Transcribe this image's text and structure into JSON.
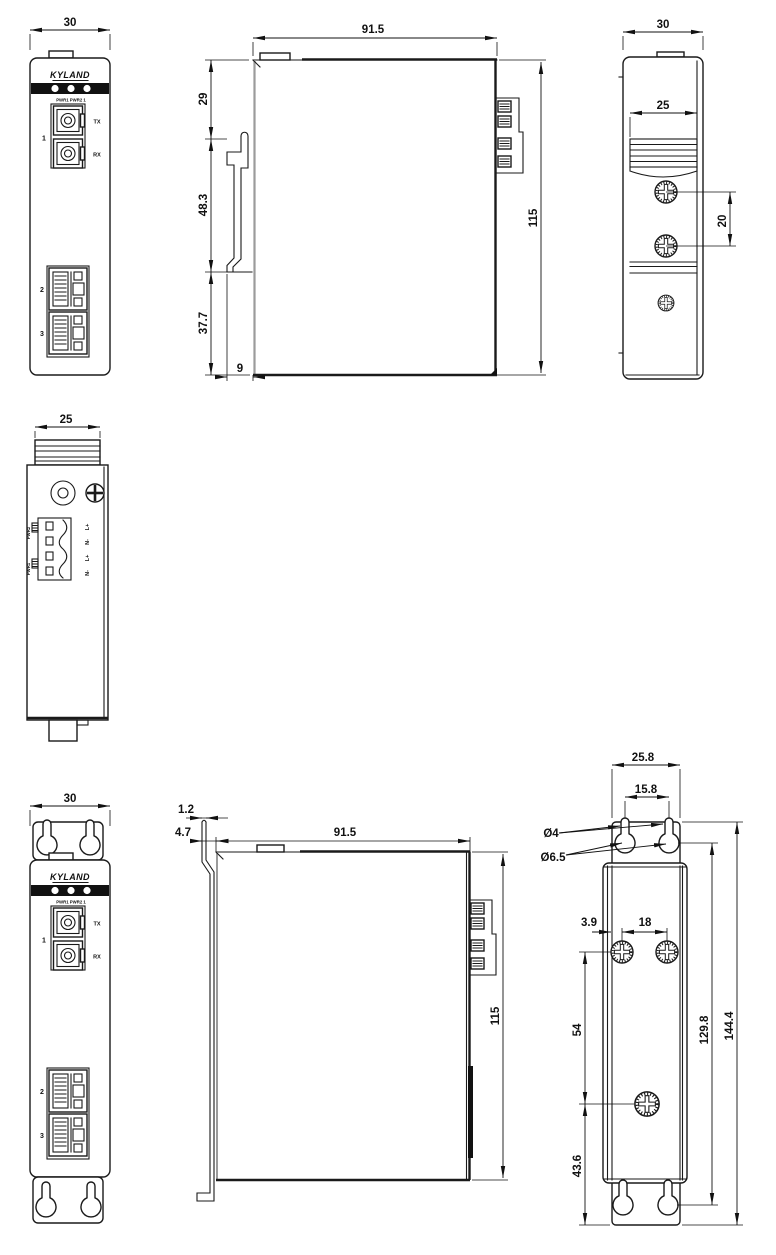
{
  "views": {
    "front_din": {
      "dim_width": "30",
      "logo": "KYLAND",
      "led_labels": "PWR1 PWR2    1",
      "fiber_group": "1",
      "tx": "TX",
      "rx": "RX",
      "port2": "2",
      "port3": "3"
    },
    "side_din": {
      "dim_depth": "91.5",
      "seg_top": "29",
      "seg_mid": "48.3",
      "seg_bot": "37.7",
      "clip_depth": "9",
      "height": "115"
    },
    "back_din": {
      "dim_width": "30",
      "rail_width": "25",
      "screw_pitch": "20"
    },
    "top_view": {
      "rail_width": "25",
      "pwr2": "PWR2",
      "pwr1": "PWR1",
      "t1": "L+",
      "t2": "N-",
      "t3": "L+",
      "t4": "N-"
    },
    "front_wall": {
      "dim_width": "30",
      "logo": "KYLAND",
      "led_labels": "PWR1 PWR2    1",
      "fiber_group": "1",
      "tx": "TX",
      "rx": "RX",
      "port2": "2",
      "port3": "3"
    },
    "side_wall": {
      "plate_thickness": "1.2",
      "plate_offset": "4.7",
      "depth": "91.5",
      "height": "115"
    },
    "back_wall": {
      "plate_width": "25.8",
      "slot_pitch": "15.8",
      "dia_slot": "Ø4",
      "dia_hole": "Ø6.5",
      "screw_edge": "3.9",
      "screw_pitch": "18",
      "screw_span": "54",
      "bottom_offset": "43.6",
      "hole_span": "129.8",
      "plate_height": "144.4"
    }
  }
}
